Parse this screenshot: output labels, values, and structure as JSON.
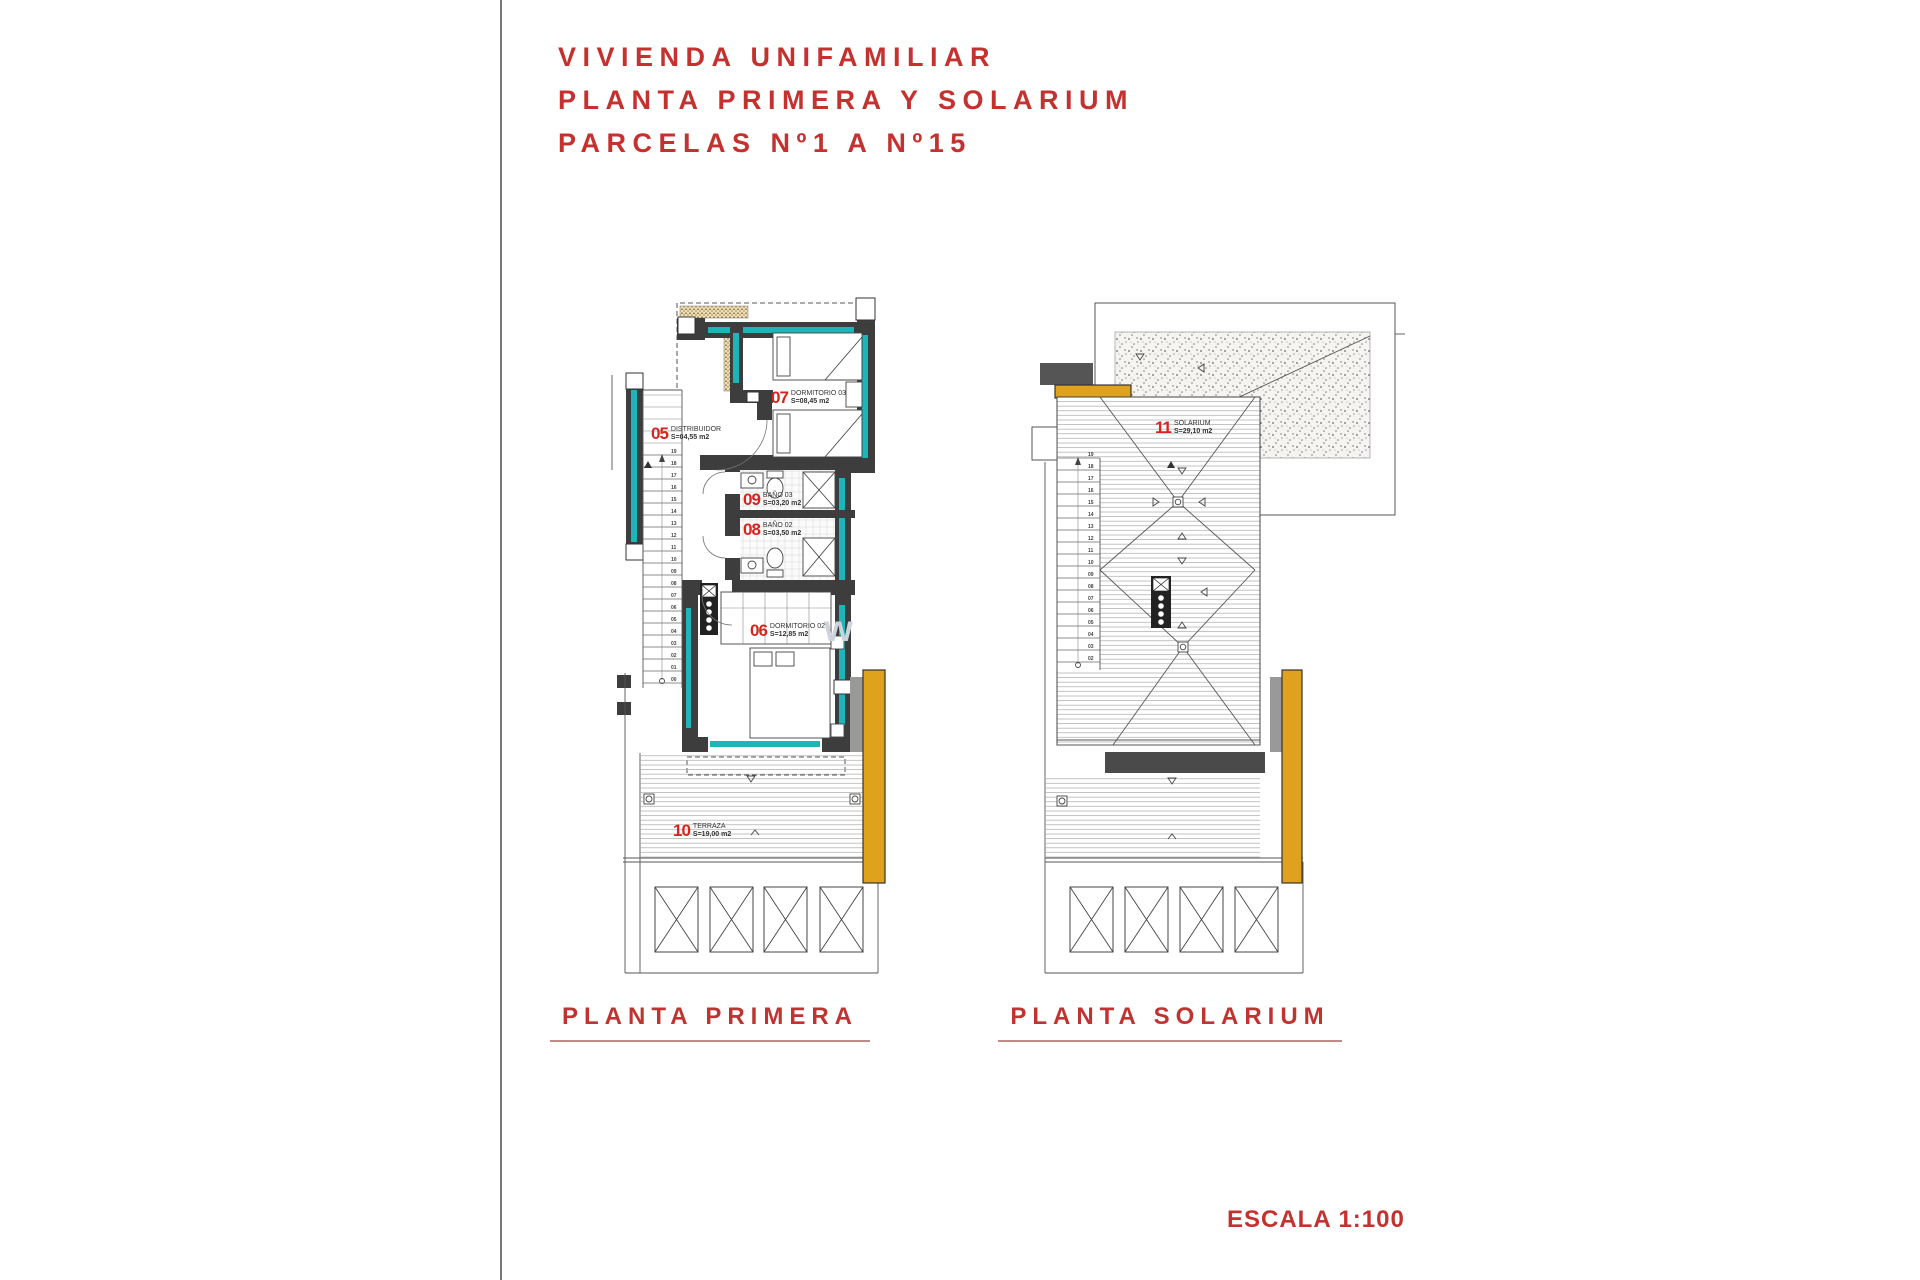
{
  "title": {
    "lines": [
      "VIVIENDA UNIFAMILIAR",
      "PLANTA PRIMERA Y SOLARIUM",
      "PARCELAS Nº1 A Nº15"
    ]
  },
  "plans": {
    "primera": {
      "caption": "PLANTA PRIMERA",
      "rooms": {
        "distribuidor": {
          "number": "05",
          "name": "DISTRIBUIDOR",
          "area": "S=04,55 m2"
        },
        "dormitorio3": {
          "number": "07",
          "name": "DORMITORIO 03",
          "area": "S=08,45 m2"
        },
        "bano3": {
          "number": "09",
          "name": "BAÑO 03",
          "area": "S=03,20 m2"
        },
        "bano2": {
          "number": "08",
          "name": "BAÑO 02",
          "area": "S=03,50 m2"
        },
        "dormitorio2": {
          "number": "06",
          "name": "DORMITORIO 02",
          "area": "S=12,85 m2"
        },
        "terraza": {
          "number": "10",
          "name": "TERRAZA",
          "area": "S=19,00 m2"
        }
      },
      "stair_numbers": [
        "19",
        "18",
        "17",
        "16",
        "15",
        "14",
        "13",
        "12",
        "11",
        "10",
        "09",
        "08",
        "07",
        "06",
        "05",
        "04",
        "03",
        "02",
        "01",
        "00"
      ]
    },
    "solarium": {
      "caption": "PLANTA SOLARIUM",
      "rooms": {
        "solarium": {
          "number": "11",
          "name": "SOLARIUM",
          "area": "S=29,10 m2"
        }
      },
      "stair_numbers": [
        "19",
        "18",
        "17",
        "16",
        "15",
        "14",
        "13",
        "12",
        "11",
        "10",
        "09",
        "08",
        "07",
        "06",
        "05",
        "04",
        "03",
        "02"
      ]
    }
  },
  "scale": {
    "label": "ESCALA 1:100"
  },
  "watermark": {
    "text": "w"
  },
  "colors": {
    "title_red": "#c4312e",
    "room_number_red": "#d6251f",
    "glazing_teal": "#1cb5b8",
    "wall_dark": "#3d3d3d",
    "pergola_orange": "#dfa21c",
    "slab_gray": "#999999"
  }
}
